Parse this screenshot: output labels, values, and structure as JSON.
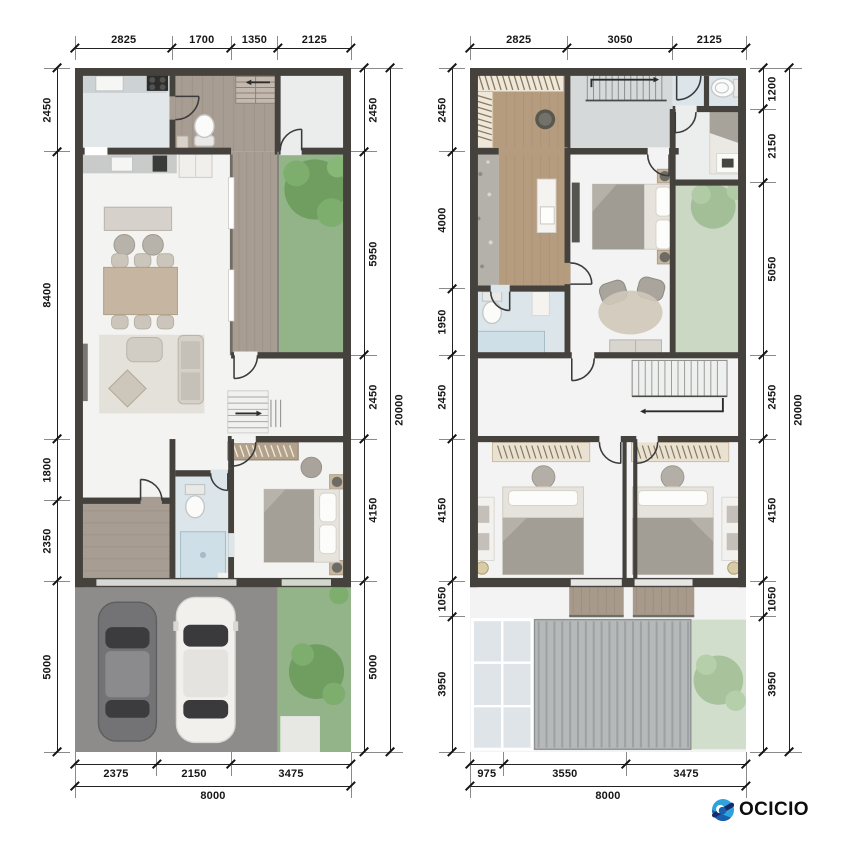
{
  "sheet": {
    "background": "#ffffff",
    "units": "mm"
  },
  "logo": {
    "text": "OCICIO"
  },
  "palette": {
    "dimension_text": "#161616",
    "dimension_line": "#222222",
    "wall": "#45423e",
    "wood_floor": "#b69c7f",
    "deck_wood": "#a89d93",
    "garden_green": "#93b388",
    "pale_green": "#cbd8c4",
    "bath_blue": "#dce5ea",
    "garage_gray": "#8d8c8a",
    "logo_light_blue": "#2da2dc",
    "logo_blue": "#1a5fad",
    "logo_navy": "#1a2a6e"
  },
  "plans": {
    "left": {
      "title": "ground-floor-plan",
      "dims": {
        "top": [
          "2825",
          "1700",
          "1350",
          "2125"
        ],
        "left": [
          "2450",
          "8400",
          "1800",
          "2350",
          "5000"
        ],
        "right": [
          "2450",
          "5950",
          "2450",
          "4150",
          "5000"
        ],
        "right_total": [
          "20000"
        ],
        "bottom": [
          "2375",
          "2150",
          "3475"
        ],
        "bottom_total": [
          "8000"
        ]
      }
    },
    "right": {
      "title": "second-floor-plan",
      "dims": {
        "top": [
          "2825",
          "3050",
          "2125"
        ],
        "left": [
          "2450",
          "4000",
          "1950",
          "2450",
          "4150",
          "1050",
          "3950"
        ],
        "right": [
          "1200",
          "2150",
          "5050",
          "2450",
          "4150",
          "1050",
          "3950"
        ],
        "right_total": [
          "20000"
        ],
        "bottom": [
          "975",
          "3550",
          "3475"
        ],
        "bottom_total": [
          "8000"
        ]
      }
    }
  }
}
